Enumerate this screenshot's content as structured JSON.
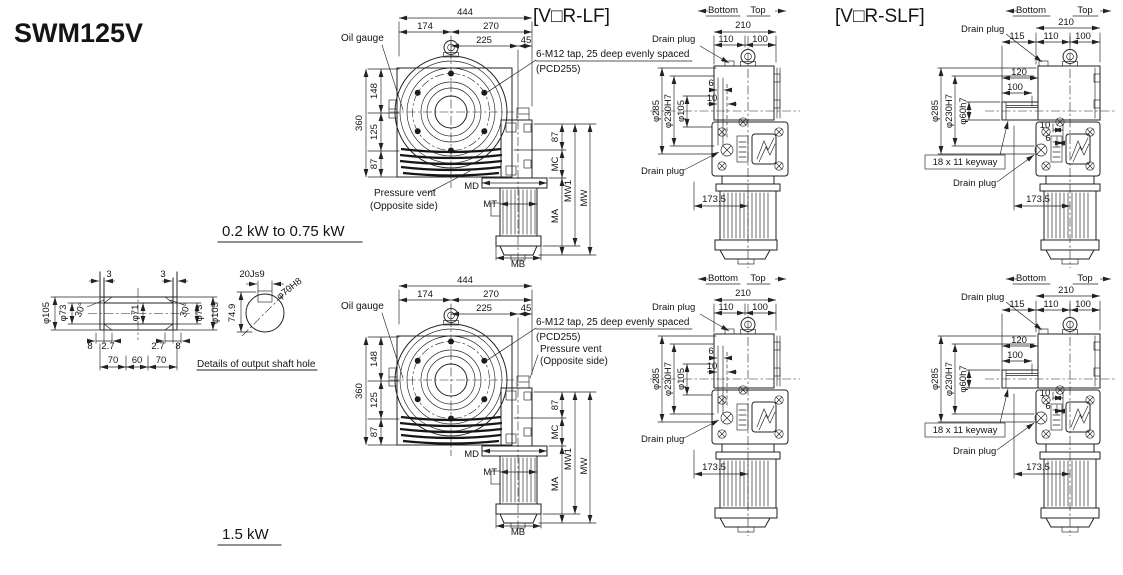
{
  "title": "SWM125V",
  "labels": {
    "power_small": "0.2 kW to 0.75 kW",
    "power_large": "1.5 kW",
    "lf_header": "[V□R-LF]",
    "slf_header": "[V□R-SLF]",
    "shaft_note": "Details of output shaft hole"
  },
  "front": {
    "dims": {
      "overall_w": "444",
      "left_w": "174",
      "right_w": "270",
      "motor_cl": "225",
      "edge": "45",
      "overall_h": "360",
      "upper_h": "148",
      "mid_h": "125",
      "lower_h": "87",
      "right_h": "87"
    },
    "mounts": {
      "MD": "MD",
      "MT": "MT",
      "MA": "MA",
      "MB": "MB",
      "MC": "MC",
      "MW": "MW",
      "MW1": "MW1"
    },
    "notes": {
      "oil_gauge": "Oil gauge",
      "tap": "6-M12 tap, 25 deep evenly spaced",
      "pcd": "(PCD255)",
      "vent_1": "Pressure vent",
      "vent_2": "(Opposite side)"
    }
  },
  "lf": {
    "bottom": "Bottom",
    "top": "Top",
    "drain_top": "Drain plug",
    "drain_bottom": "Drain plug",
    "dims": {
      "w": "210",
      "w_left": "110",
      "w_right": "100",
      "step_a": "6",
      "step_b": "10",
      "flange_od": "φ285",
      "spigot": "φ230H7",
      "bore": "φ105",
      "motor_off": "173.5"
    }
  },
  "slf": {
    "bottom": "Bottom",
    "top": "Top",
    "drain_top": "Drain plug",
    "drain_bottom": "Drain plug",
    "keyway": "18 x 11 keyway",
    "dims": {
      "w": "210",
      "shaft_len": "115",
      "w_left": "110",
      "w_right": "100",
      "l120": "120",
      "l100": "100",
      "flange_od": "φ285",
      "spigot": "φ230H7",
      "shaft_d": "φ60h7",
      "step_b": "10",
      "step_a": "6",
      "motor_off": "173.5"
    }
  },
  "shaft_detail": {
    "plate_l": "3",
    "plate_r": "3",
    "od_l": "φ105",
    "bore_l": "φ73",
    "ang_l": "30°",
    "bore_c": "φ71",
    "ang_r": "30°",
    "bore_r": "φ73",
    "od_r": "φ105",
    "b8l": "8",
    "b27l": "2.7",
    "b27r": "2.7",
    "b8r": "8",
    "s70l": "70",
    "s60": "60",
    "s70r": "70",
    "key": "20Js9",
    "depth": "74.9",
    "hole": "φ70H8"
  }
}
